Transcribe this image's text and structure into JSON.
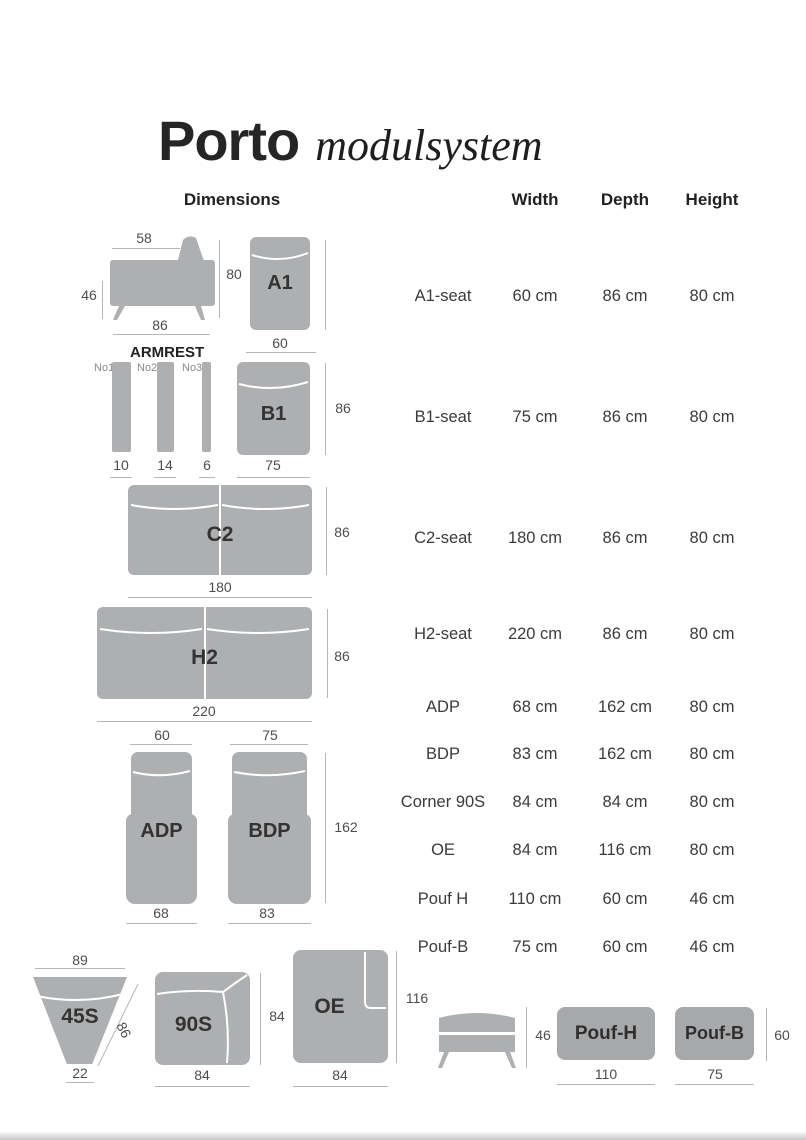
{
  "title": {
    "main": "Porto",
    "sub": "modulsystem"
  },
  "columns": {
    "dimensions": "Dimensions",
    "width": "Width",
    "depth": "Depth",
    "height": "Height"
  },
  "rows": [
    {
      "label": "A1-seat",
      "width": "60 cm",
      "depth": "86 cm",
      "height": "80 cm"
    },
    {
      "label": "B1-seat",
      "width": "75 cm",
      "depth": "86 cm",
      "height": "80 cm"
    },
    {
      "label": "C2-seat",
      "width": "180 cm",
      "depth": "86 cm",
      "height": "80 cm"
    },
    {
      "label": "H2-seat",
      "width": "220 cm",
      "depth": "86 cm",
      "height": "80 cm"
    },
    {
      "label": "ADP",
      "width": "68 cm",
      "depth": "162 cm",
      "height": "80 cm"
    },
    {
      "label": "BDP",
      "width": "83 cm",
      "depth": "162 cm",
      "height": "80 cm"
    },
    {
      "label": "Corner 90S",
      "width": "84 cm",
      "depth": "84 cm",
      "height": "80 cm"
    },
    {
      "label": "OE",
      "width": "84 cm",
      "depth": "116 cm",
      "height": "80 cm"
    },
    {
      "label": "Pouf H",
      "width": "110 cm",
      "depth": "60 cm",
      "height": "46 cm"
    },
    {
      "label": "Pouf-B",
      "width": "75 cm",
      "depth": "60 cm",
      "height": "46 cm"
    }
  ],
  "diagrams": {
    "side_view": {
      "top": "58",
      "left": "46",
      "bottom": "86",
      "height": "80"
    },
    "a1": {
      "label": "A1",
      "width": "60"
    },
    "armrest": {
      "title": "ARMREST",
      "items": [
        {
          "name": "No1",
          "value": "10"
        },
        {
          "name": "No2",
          "value": "14"
        },
        {
          "name": "No3",
          "value": "6"
        }
      ]
    },
    "b1": {
      "label": "B1",
      "depth": "86",
      "width": "75"
    },
    "c2": {
      "label": "C2",
      "depth": "86",
      "width": "180"
    },
    "h2": {
      "label": "H2",
      "depth": "86",
      "width": "220"
    },
    "adp": {
      "label": "ADP",
      "top": "60",
      "bottom": "68"
    },
    "bdp": {
      "label": "BDP",
      "top": "75",
      "bottom": "83",
      "height": "162"
    },
    "s45": {
      "label": "45S",
      "top": "89",
      "bottom": "22",
      "side": "86"
    },
    "s90": {
      "label": "90S",
      "right": "84",
      "bottom": "84"
    },
    "oe": {
      "label": "OE",
      "right": "116",
      "bottom": "84"
    },
    "pouf_side": {
      "right": "46"
    },
    "pouf_h": {
      "label": "Pouf-H",
      "bottom": "110"
    },
    "pouf_b": {
      "label": "Pouf-B",
      "bottom": "75",
      "right": "60"
    }
  },
  "colors": {
    "module_fill": "#adafb1",
    "pouf_fill": "#a6a8aa",
    "dim_line": "#b6b6b6"
  }
}
